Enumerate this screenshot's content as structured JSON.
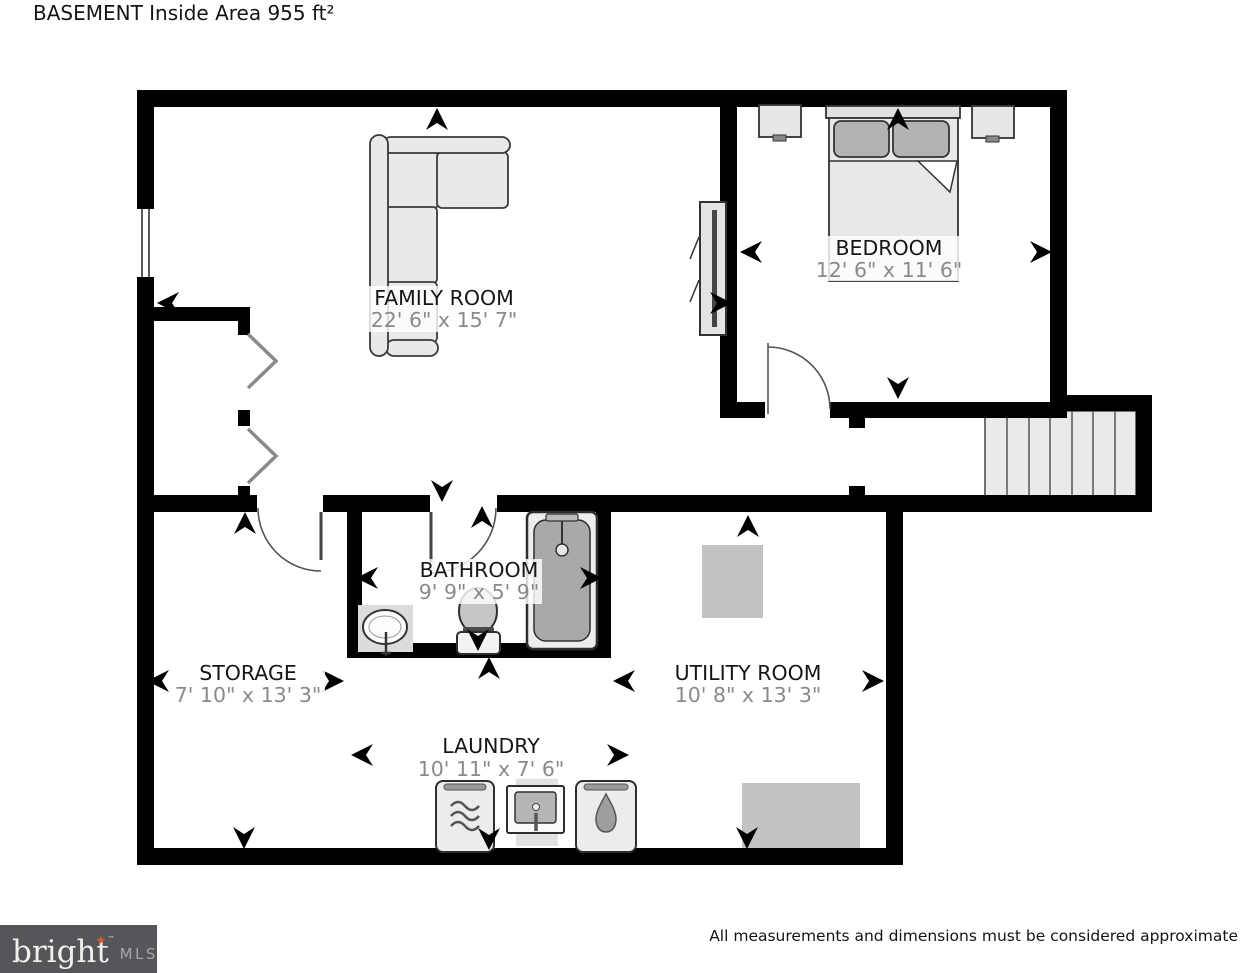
{
  "title": "BASEMENT Inside Area 955 ft²",
  "rooms": {
    "family_room": {
      "name": "FAMILY ROOM",
      "dims": "22' 6\" x 15' 7\""
    },
    "bedroom": {
      "name": "BEDROOM",
      "dims": "12' 6\" x 11' 6\""
    },
    "bathroom": {
      "name": "BATHROOM",
      "dims": "9' 9\" x 5' 9\""
    },
    "storage": {
      "name": "STORAGE",
      "dims": "7' 10\" x 13' 3\""
    },
    "utility_room": {
      "name": "UTILITY ROOM",
      "dims": "10' 8\" x 13' 3\""
    },
    "laundry": {
      "name": "LAUNDRY",
      "dims": "10' 11\" x 7' 6\""
    }
  },
  "footer": {
    "brand": "bright",
    "trademark": "™",
    "brand_suffix": "MLS",
    "star": "✦",
    "disclaimer": "All measurements and dimensions must be considered approximate"
  },
  "colors": {
    "wall": "#000000",
    "room_name_text": "#161616",
    "dimension_text": "#8a8a8a",
    "furniture_fill": "#ececec",
    "equipment_fill": "#c2c2c2",
    "logo_background": "#55565a",
    "logo_text": "#f2f0eb",
    "logo_mls_text": "#a6a6a8",
    "logo_star": "#d8572e"
  }
}
